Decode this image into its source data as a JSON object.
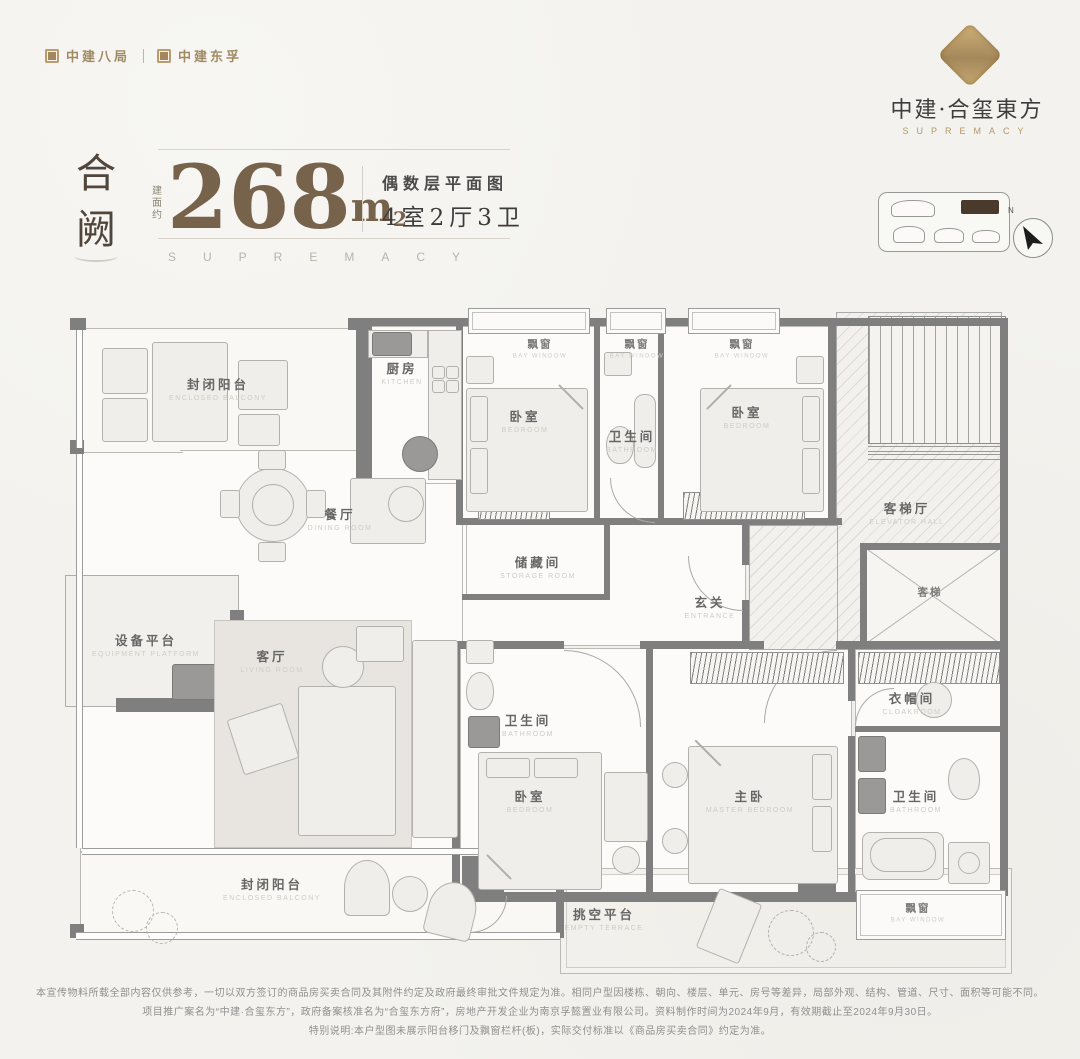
{
  "header": {
    "logo_left_1": "中建八局",
    "logo_left_2": "中建东孚",
    "brand_name": "中建·合玺東方",
    "brand_subtitle": "SUPREMACY"
  },
  "title_block": {
    "unit_name": "合阙",
    "area_prefix": "建面约",
    "area_value": "268",
    "area_unit": "m",
    "area_sup": "2",
    "floor_label": "偶数层平面图",
    "layout_label": "4室2厅3卫",
    "watermark": "SUPREMACY"
  },
  "key_plan": {
    "north_label": "N"
  },
  "plan": {
    "rooms": [
      {
        "cn": "封闭阳台",
        "en": "ENCLOSED BALCONY"
      },
      {
        "cn": "厨房",
        "en": "KITCHEN"
      },
      {
        "cn": "飘窗",
        "en": "BAY WINDOW"
      },
      {
        "cn": "飘窗",
        "en": "BAY WINDOW"
      },
      {
        "cn": "飘窗",
        "en": "BAY WINDOW"
      },
      {
        "cn": "卧室",
        "en": "BEDROOM"
      },
      {
        "cn": "卫生间",
        "en": "BATHROOM"
      },
      {
        "cn": "卧室",
        "en": "BEDROOM"
      },
      {
        "cn": "客梯厅",
        "en": "ELEVATOR HALL"
      },
      {
        "cn": "客梯",
        "en": ""
      },
      {
        "cn": "储藏间",
        "en": "STORAGE ROOM"
      },
      {
        "cn": "玄关",
        "en": "ENTRANCE"
      },
      {
        "cn": "餐厅",
        "en": "DINING ROOM"
      },
      {
        "cn": "设备平台",
        "en": "EQUIPMENT PLATFORM"
      },
      {
        "cn": "客厅",
        "en": "LIVING ROOM"
      },
      {
        "cn": "卫生间",
        "en": "BATHROOM"
      },
      {
        "cn": "卧室",
        "en": "BEDROOM"
      },
      {
        "cn": "主卧",
        "en": "MASTER BEDROOM"
      },
      {
        "cn": "衣帽间",
        "en": "CLOAKROOM"
      },
      {
        "cn": "卫生间",
        "en": "BATHROOM"
      },
      {
        "cn": "飘窗",
        "en": "BAY WINDOW"
      },
      {
        "cn": "封闭阳台",
        "en": "ENCLOSED BALCONY"
      },
      {
        "cn": "挑空平台",
        "en": "EMPTY TERRACE"
      }
    ]
  },
  "footer": {
    "lines": [
      "本宣传物料所载全部内容仅供参考，一切以双方签订的商品房买卖合同及其附件约定及政府最终审批文件规定为准。相同户型因楼栋、朝向、楼层、单元、房号等差异，局部外观、结构、管道、尺寸、面积等可能不同。",
      "项目推广案名为“中建·合玺东方”，政府备案核准名为“合玺东方府”，房地产开发企业为南京孚懿置业有限公司。资料制作时间为2024年9月，有效期截止至2024年9月30日。",
      "特别说明:本户型图未展示阳台移门及飘窗栏杆(板)，实际交付标准以《商品房买卖合同》约定为准。"
    ]
  },
  "colors": {
    "accent_gold": "#a8906a",
    "bronze_text": "#77634b",
    "wall_gray": "#7f7f7f",
    "page_bg": "#f3f2ee",
    "highlight_unit": "#4a3a2c"
  }
}
